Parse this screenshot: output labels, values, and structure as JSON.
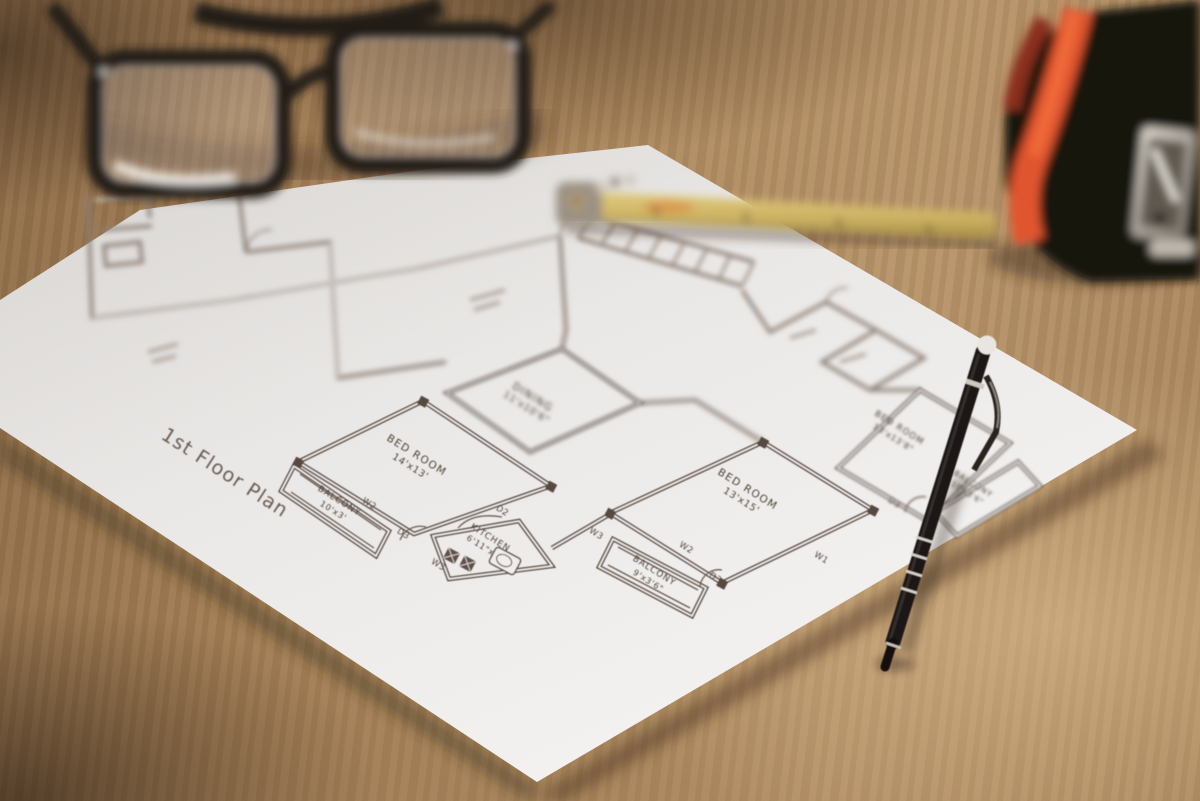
{
  "photo": {
    "kind": "photograph of an architectural floor plan on a wooden desk",
    "colors": {
      "wood": "#a3815c",
      "paper": "#edebe9",
      "plan_line": "#5a4a42",
      "pen_black": "#1b1713",
      "ruler_yellow": "#cdb363",
      "tape_orange": "#dd5530",
      "tape_black": "#1a140f",
      "glasses_black": "#201a16"
    }
  },
  "plan": {
    "title": "1st Floor Plan",
    "rooms": {
      "bedroom_left": {
        "name": "BED ROOM",
        "dims": "14'x13'"
      },
      "balcony_left": {
        "name": "BALCONY",
        "dims": "10'x3'"
      },
      "kitchen": {
        "name": "KITCHEN",
        "dims": "6'11\"x7'"
      },
      "dining": {
        "name": "DINING",
        "dims": "11'x10'6\""
      },
      "bedroom_right": {
        "name": "BED ROOM",
        "dims": "13'x15'"
      },
      "balcony_right": {
        "name": "BALCONY",
        "dims": "9'x3'6\""
      },
      "bedroom_far": {
        "name": "BED ROOM",
        "dims": "13'x13'8\""
      },
      "balcony_far": {
        "name": "BALCONY",
        "dims": "10'x3'6\""
      }
    },
    "markers": {
      "w2_left": "W2",
      "d3_left": "D3",
      "w3_kitchen": "W3",
      "d2_kitchen": "D2",
      "w3_mid": "W3",
      "w2_right": "W2",
      "d3_right": "D3",
      "w1_right": "W1",
      "d3_far": "D3"
    }
  },
  "objects": {
    "paper": "floor-plan-sheet",
    "glasses": "black-framed-eyeglasses",
    "ruler": "yellow-folding-ruler",
    "tape": "measuring-tape",
    "pen": "black-ballpoint-pen"
  }
}
